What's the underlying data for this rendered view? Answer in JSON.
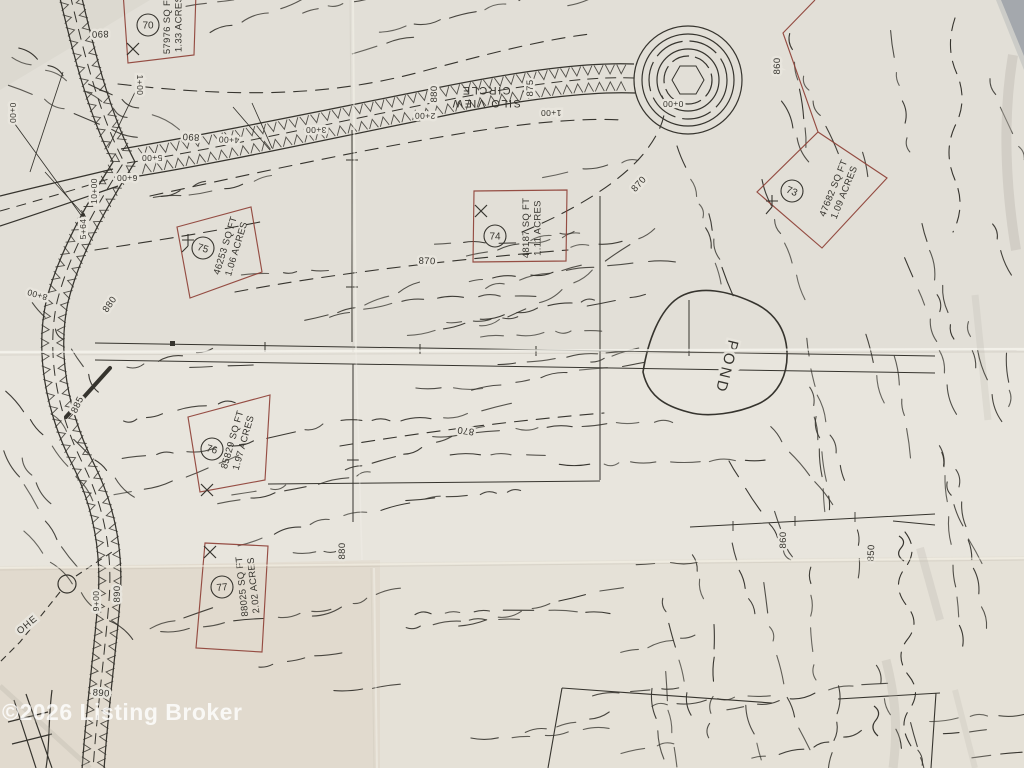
{
  "photo": {
    "watermark": "©2026 Listing Broker"
  },
  "map": {
    "road_name": {
      "line1": "SILO VIEW",
      "line2": "CIRCLE",
      "x": 486,
      "y": 97,
      "rot": 180
    },
    "pond": {
      "label": "POND",
      "x": 722,
      "y": 366,
      "rot": 104
    },
    "utility": {
      "label": "OHE",
      "x": 29,
      "y": 627,
      "rot": -40
    },
    "lots": [
      {
        "number": "70",
        "area_sqft": "57976 SQ FT",
        "acres": "1.33 ACRES",
        "circle": {
          "x": 148,
          "y": 25
        },
        "text": {
          "x": 172,
          "y": 24,
          "rot": -90
        }
      },
      {
        "number": "73",
        "area_sqft": "47682 SQ FT",
        "acres": "1.09 ACRES",
        "circle": {
          "x": 792,
          "y": 191
        },
        "text": {
          "x": 838,
          "y": 190,
          "rot": -68
        }
      },
      {
        "number": "74",
        "area_sqft": "48187 SQ FT",
        "acres": "1.11 ACRES",
        "circle": {
          "x": 495,
          "y": 236
        },
        "text": {
          "x": 531,
          "y": 228,
          "rot": -90
        }
      },
      {
        "number": "75",
        "area_sqft": "46253 SQ FT",
        "acres": "1.06 ACRES",
        "circle": {
          "x": 203,
          "y": 248
        },
        "text": {
          "x": 230,
          "y": 247,
          "rot": -73
        }
      },
      {
        "number": "76",
        "area_sqft": "85829 SQ FT",
        "acres": "1.97 ACRES",
        "circle": {
          "x": 212,
          "y": 449
        },
        "text": {
          "x": 237,
          "y": 441,
          "rot": -74
        }
      },
      {
        "number": "77",
        "area_sqft": "88025 SQ FT",
        "acres": "2.02 ACRES",
        "circle": {
          "x": 222,
          "y": 587
        },
        "text": {
          "x": 247,
          "y": 586,
          "rot": -96
        }
      }
    ],
    "contour_labels": [
      {
        "text": "890",
        "x": 100,
        "y": 31,
        "rot": 178
      },
      {
        "text": "880",
        "x": 437,
        "y": 94,
        "rot": -90
      },
      {
        "text": "875",
        "x": 533,
        "y": 88,
        "rot": -90
      },
      {
        "text": "890",
        "x": 191,
        "y": 134,
        "rot": 183
      },
      {
        "text": "885",
        "x": 80,
        "y": 406,
        "rot": -65
      },
      {
        "text": "880",
        "x": 112,
        "y": 306,
        "rot": -55
      },
      {
        "text": "870",
        "x": 641,
        "y": 186,
        "rot": -48
      },
      {
        "text": "860",
        "x": 780,
        "y": 66,
        "rot": -90
      },
      {
        "text": "870",
        "x": 427,
        "y": 264,
        "rot": 2
      },
      {
        "text": "870",
        "x": 466,
        "y": 428,
        "rot": 188
      },
      {
        "text": "880",
        "x": 345,
        "y": 551,
        "rot": -90
      },
      {
        "text": "860",
        "x": 786,
        "y": 540,
        "rot": -90
      },
      {
        "text": "850",
        "x": 874,
        "y": 553,
        "rot": -88
      },
      {
        "text": "890",
        "x": 120,
        "y": 594,
        "rot": -90
      },
      {
        "text": "890",
        "x": 101,
        "y": 696,
        "rot": 4
      }
    ],
    "station_labels": [
      {
        "text": "0+00",
        "x": 673,
        "y": 101,
        "rot": 180
      },
      {
        "text": "1+00",
        "x": 551,
        "y": 110,
        "rot": 180
      },
      {
        "text": "2+00",
        "x": 425,
        "y": 113,
        "rot": 181
      },
      {
        "text": "3+00",
        "x": 316,
        "y": 127,
        "rot": 180
      },
      {
        "text": "4+00",
        "x": 229,
        "y": 137,
        "rot": 183
      },
      {
        "text": "5+00",
        "x": 152,
        "y": 155,
        "rot": 180
      },
      {
        "text": "6+00",
        "x": 127,
        "y": 175,
        "rot": 180
      },
      {
        "text": "8+00",
        "x": 38,
        "y": 292,
        "rot": 196
      },
      {
        "text": "9+00",
        "x": 99,
        "y": 601,
        "rot": -90
      },
      {
        "text": "0+00",
        "x": 10,
        "y": 113,
        "rot": 90
      },
      {
        "text": "1+00",
        "x": 137,
        "y": 85,
        "rot": 90
      },
      {
        "text": "10+00",
        "x": 97,
        "y": 191,
        "rot": -90
      },
      {
        "text": "5+64",
        "x": 86,
        "y": 229,
        "rot": -90
      }
    ],
    "colors": {
      "ink": "#36342e",
      "lot_boundary": "#8e4036",
      "paper": "#e8e5dd"
    }
  }
}
